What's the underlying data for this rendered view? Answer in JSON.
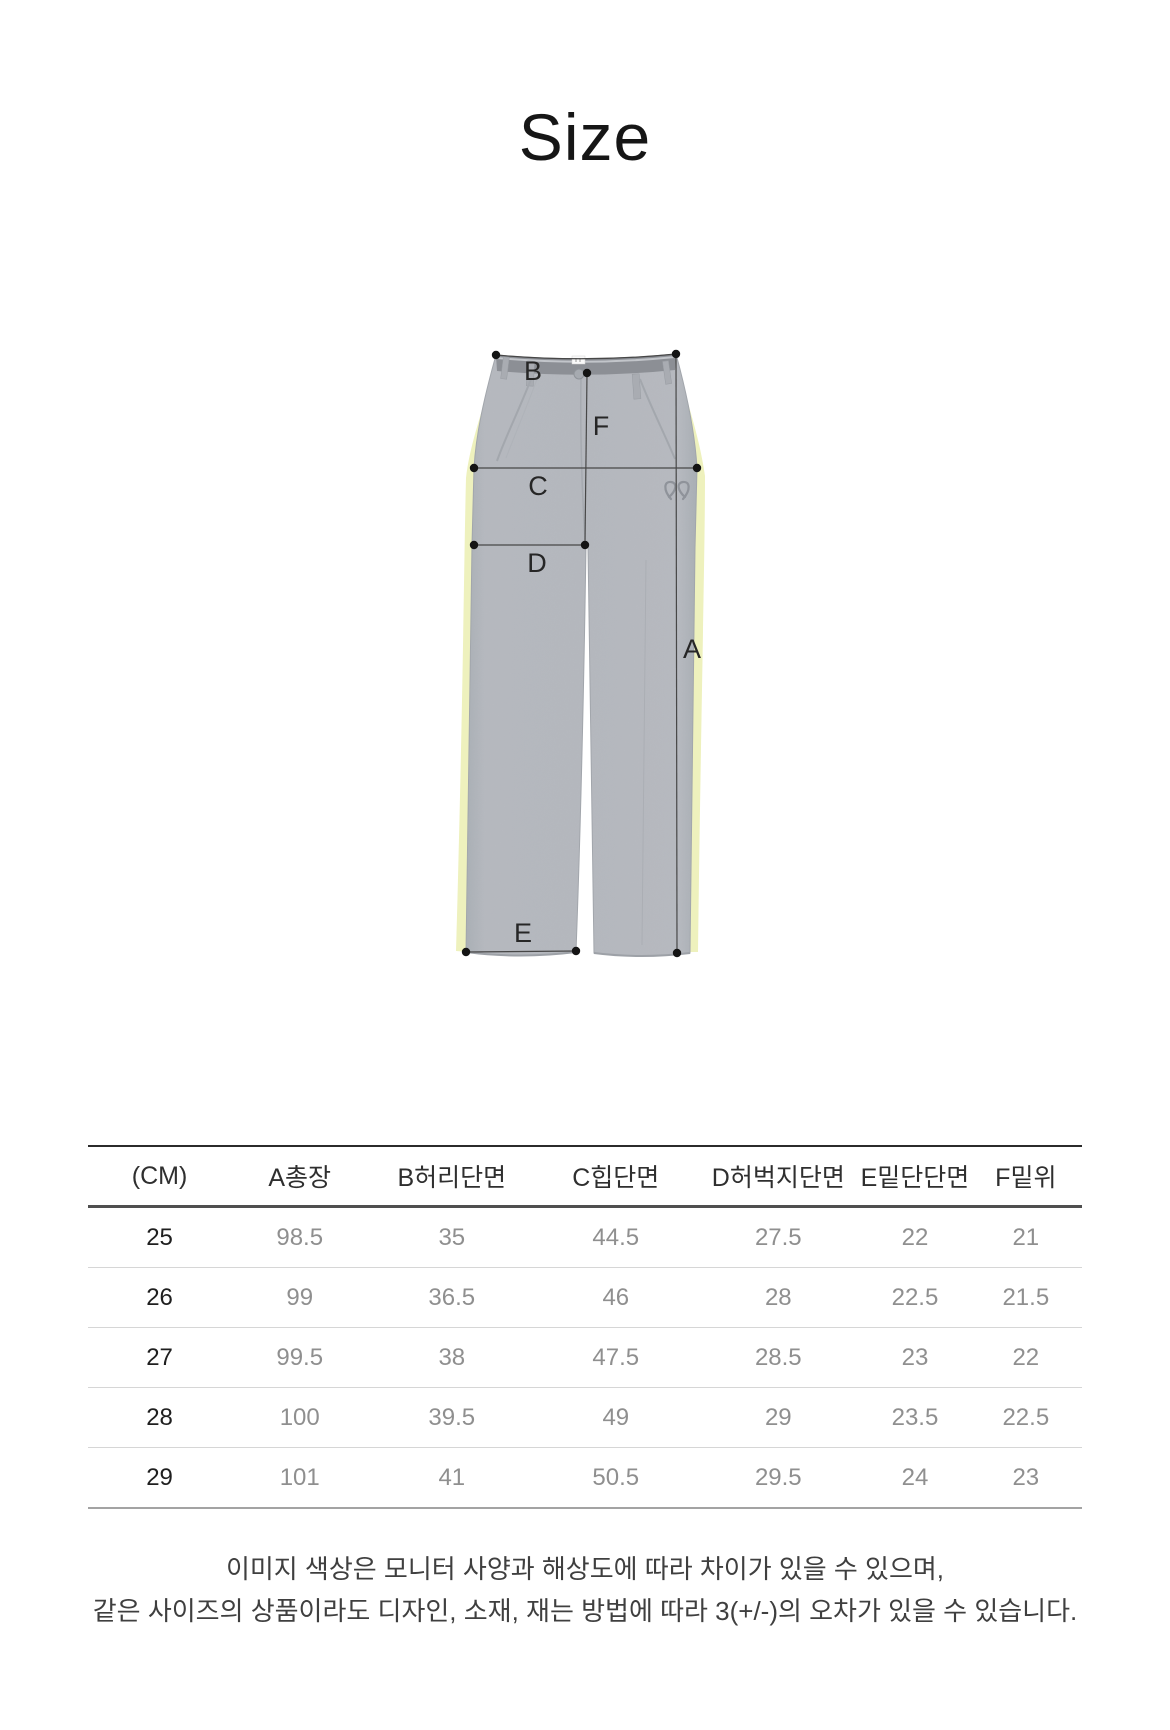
{
  "title": "Size",
  "diagram": {
    "labels": {
      "total_length": "A",
      "waist": "B",
      "hip": "C",
      "thigh": "D",
      "hem": "E",
      "rise": "F"
    },
    "colors": {
      "fabric": "#b5b8be",
      "side_stripe": "#eef1bd",
      "waistband": "#8c8f95",
      "measure_line": "#474747",
      "measure_dot": "#141414"
    }
  },
  "table": {
    "columns": [
      "(CM)",
      "A총장",
      "B허리단면",
      "C힙단면",
      "D허벅지단면",
      "E밑단단면",
      "F밑위"
    ],
    "rows": [
      [
        "25",
        "98.5",
        "35",
        "44.5",
        "27.5",
        "22",
        "21"
      ],
      [
        "26",
        "99",
        "36.5",
        "46",
        "28",
        "22.5",
        "21.5"
      ],
      [
        "27",
        "99.5",
        "38",
        "47.5",
        "28.5",
        "23",
        "22"
      ],
      [
        "28",
        "100",
        "39.5",
        "49",
        "29",
        "23.5",
        "22.5"
      ],
      [
        "29",
        "101",
        "41",
        "50.5",
        "29.5",
        "24",
        "23"
      ]
    ]
  },
  "footer": {
    "line1": "이미지 색상은 모니터 사양과 해상도에 따라 차이가 있을 수 있으며,",
    "line2": "같은 사이즈의 상품이라도 디자인, 소재, 재는 방법에 따라 3(+/-)의 오차가 있을 수 있습니다."
  }
}
